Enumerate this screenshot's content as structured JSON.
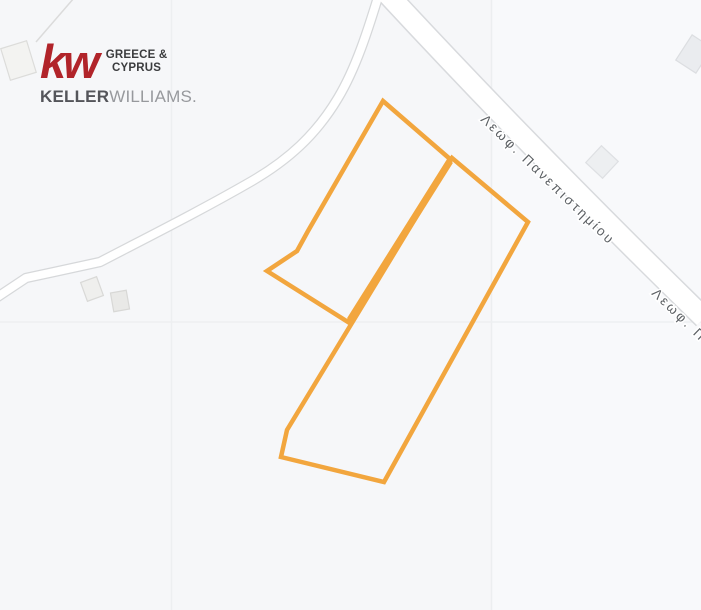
{
  "branding": {
    "kw": "kw",
    "region_line1": "GREECE &",
    "region_line2": "CYPRUS",
    "name_bold": "KELLER",
    "name_light": "WILLIAMS."
  },
  "map": {
    "road_label_main": "Λεωφ. Πανεπιστημίου",
    "road_label_secondary": "Λεωφ. Πανεπιστημίου"
  },
  "colors": {
    "plot_outline": "#F2A63E",
    "kw_red": "#B1242A",
    "road_fill": "#FFFFFF",
    "road_casing": "#D8DADD",
    "tile_line": "#EDEFF1",
    "label_text": "#5C6064",
    "background": "#F6F7F9"
  }
}
